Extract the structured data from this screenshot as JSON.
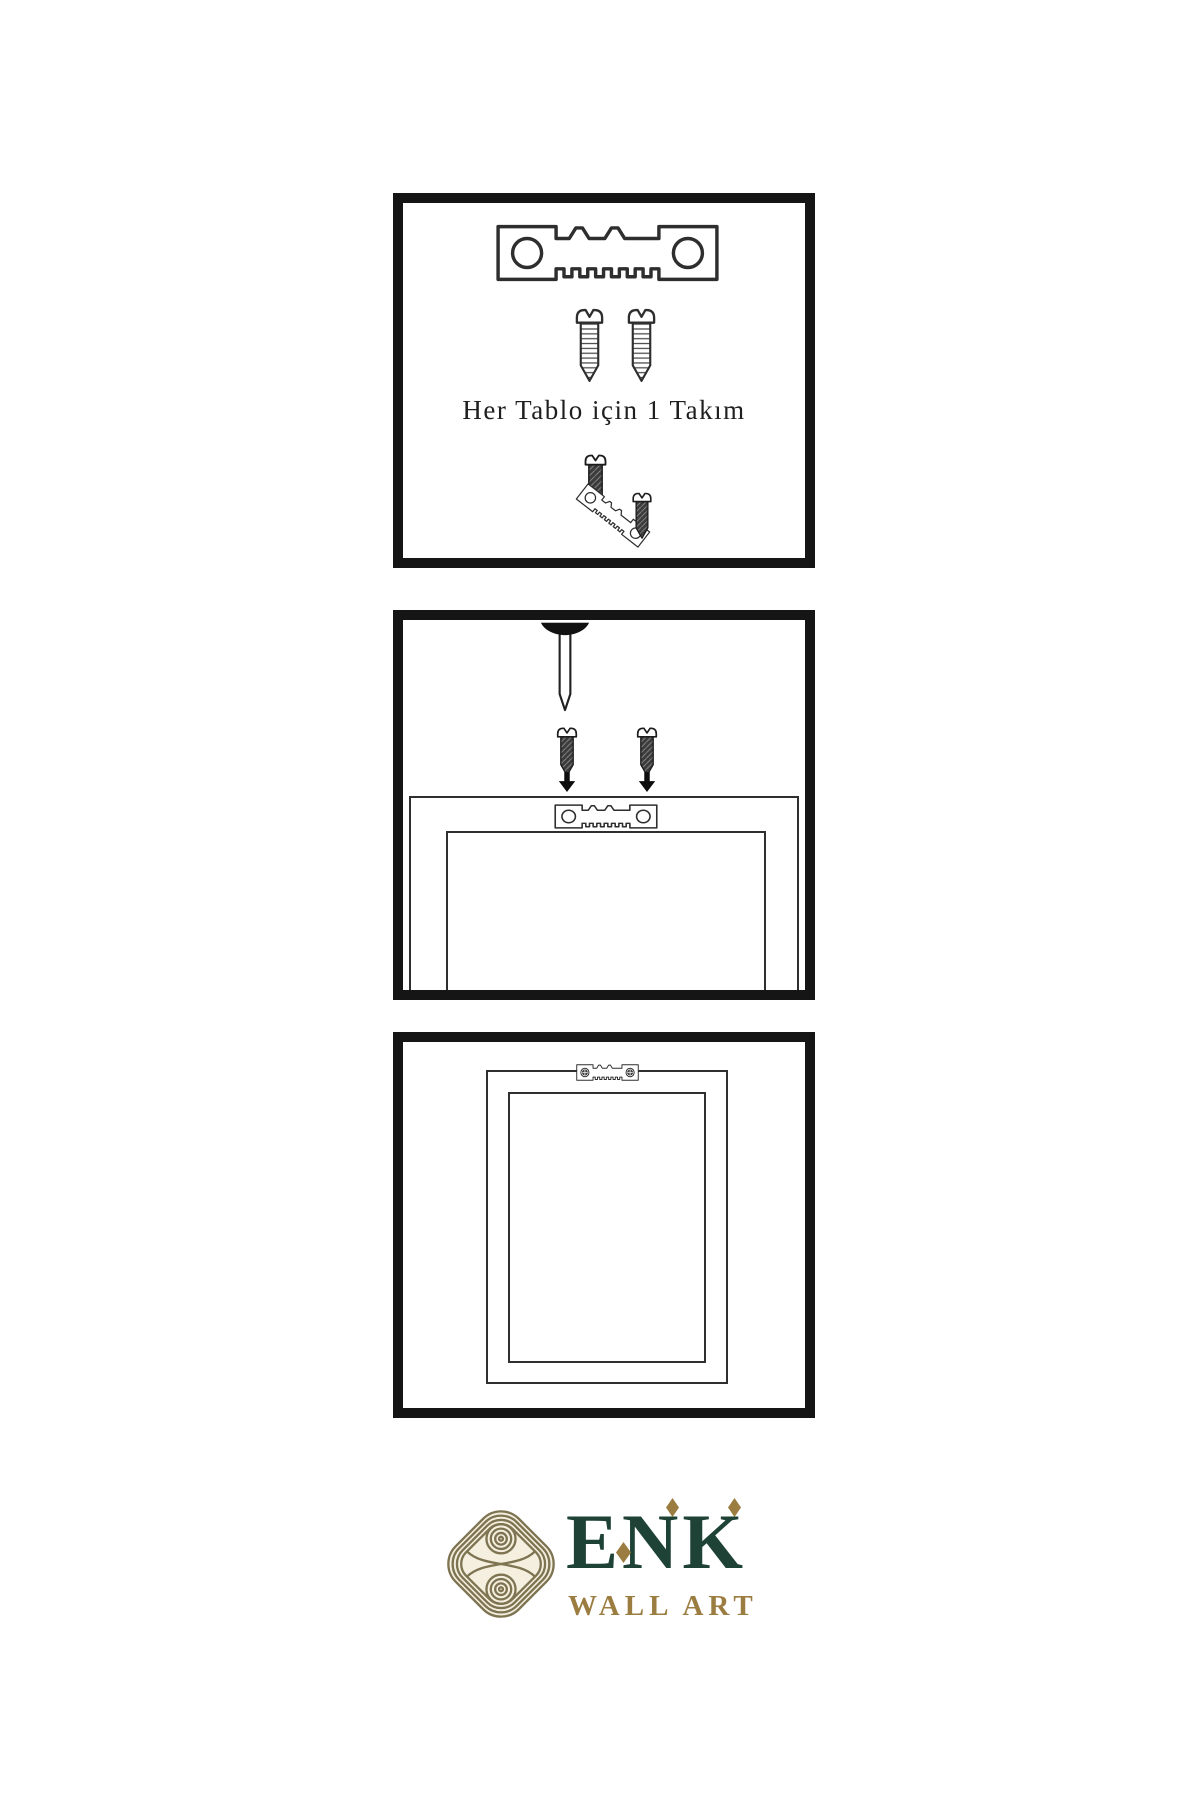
{
  "page": {
    "background": "#ffffff"
  },
  "colors": {
    "panel_border": "#151515",
    "line_art": "#2e2e2e",
    "solid_black": "#111111",
    "logo_green": "#1e4236",
    "logo_gold": "#9c7d41",
    "knot_gold": "#7e7452",
    "knot_cream": "#f5efdf"
  },
  "panels": {
    "kit": {
      "caption": "Her Tablo için 1 Takım",
      "icons": [
        "sawtooth-hanger-icon",
        "screw-icon",
        "screw-icon",
        "dark-screw-icon",
        "tilted-sawtooth-hanger-icon",
        "dark-screw-icon"
      ]
    },
    "mounting": {
      "icons": [
        "wall-nail-icon",
        "dark-screw-icon",
        "dark-screw-icon",
        "down-arrow-icon",
        "down-arrow-icon",
        "frame-back",
        "sawtooth-hanger-icon"
      ]
    },
    "mounted": {
      "icons": [
        "frame-back",
        "sawtooth-hanger-screwed-icon"
      ]
    }
  },
  "logo": {
    "brand": "ENK",
    "subtitle": "WALL ART",
    "icons": [
      "knot-icon",
      "diamond-icon",
      "diamond-icon",
      "diamond-icon"
    ]
  }
}
